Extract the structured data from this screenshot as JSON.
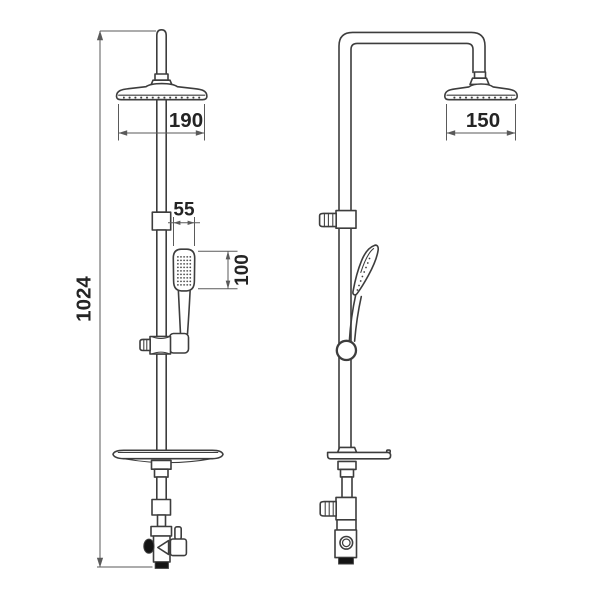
{
  "drawing": {
    "labels": {
      "overall_height": "1024",
      "front_head_width": "190",
      "side_head_width": "150",
      "handshower_width": "55",
      "handshower_height": "100"
    },
    "colors": {
      "background": "#ffffff",
      "line": "#3d3d3d",
      "dimension": "#5a5a5a",
      "text": "#242424",
      "dark_fill": "#141414"
    }
  }
}
